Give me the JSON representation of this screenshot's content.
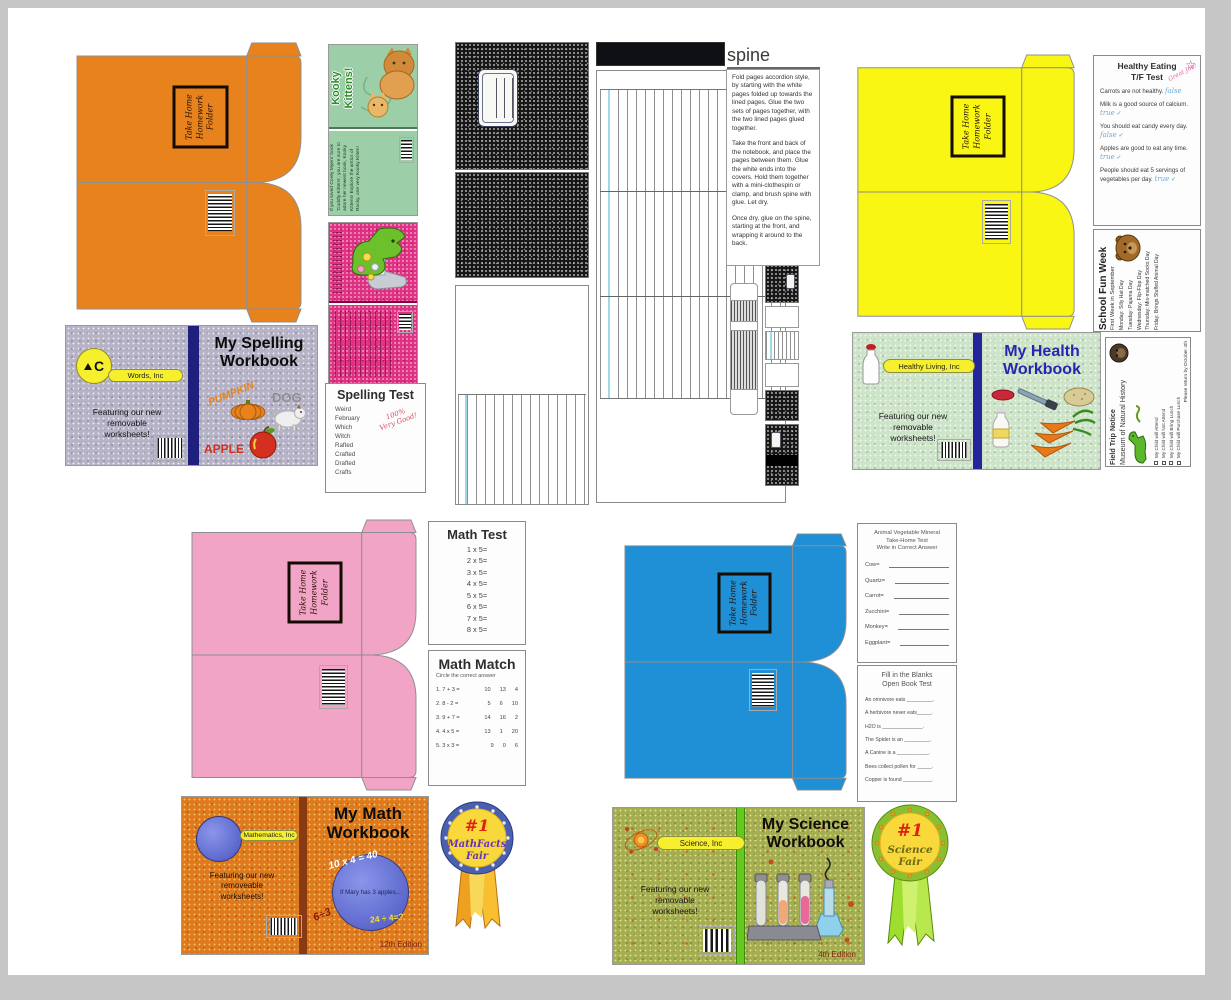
{
  "folder": {
    "label": "Take Home\nHomework\nFolder",
    "colors": {
      "orange": "#e8821c",
      "yellow": "#f8f612",
      "pink": "#f2a4c6",
      "blue": "#1f8fd6"
    }
  },
  "spelling_workbook": {
    "title": "My Spelling\nWorkbook",
    "company": "Words, Inc",
    "logo_letter": "C",
    "tagline": "Featuring our new\nremovable\nworksheets!",
    "words": {
      "pumpkin": "PUMPKIN",
      "dog": "DOG",
      "apple": "APPLE"
    },
    "cover_color": "#b7b3c7",
    "spine_color": "#1f1f7e"
  },
  "health_workbook": {
    "title": "My Health\nWorkbook",
    "company": "Healthy Living, Inc",
    "tagline": "Featuring our new\nremovable\nworksheets!",
    "cover_color": "#cde4c9",
    "spine_color": "#24249b",
    "title_color": "#2626b0"
  },
  "math_workbook": {
    "title": "My Math\nWorkbook",
    "company": "Mathematics, Inc",
    "tagline": "Featuring our new\nremoveable\nworksheets!",
    "edition": "12th Edition",
    "equations": {
      "eq1": "10 x 4 = 40",
      "eq2": "If Mary has 3 apples...",
      "eq3": "24 ÷ 4=?",
      "eq4": "6÷3"
    },
    "cover_color": "#df7a1c",
    "spine_color": "#8a3a12"
  },
  "science_workbook": {
    "title": "My Science\nWorkbook",
    "company": "Science, Inc",
    "tagline": "Featuring our new\nremovable\nworksheets!",
    "edition": "4th Edition",
    "cover_color": "#a5ad52",
    "spine_color": "#66c81e"
  },
  "spelling_test": {
    "title": "Spelling Test",
    "words": [
      "Weird",
      "February",
      "Which",
      "Witch",
      "Rafted",
      "Crafted",
      "Drafted",
      "Crafts"
    ],
    "grade": "100%\nVery Good!"
  },
  "math_test": {
    "title": "Math Test",
    "problems": [
      "1 x 5=",
      "2 x 5=",
      "3 x 5=",
      "4 x 5=",
      "5 x 5=",
      "6 x 5=",
      "7 x 5=",
      "8 x 5="
    ]
  },
  "math_match": {
    "title": "Math Match",
    "subtitle": "Circle the correct answer",
    "rows": [
      {
        "q": "1.  7 + 3 =",
        "opts": [
          "10",
          "13",
          "4"
        ]
      },
      {
        "q": "2.  8 - 2 =",
        "opts": [
          "5",
          "6",
          "10"
        ]
      },
      {
        "q": "3.  9 + 7 =",
        "opts": [
          "14",
          "16",
          "2"
        ]
      },
      {
        "q": "4.  4 x 5 =",
        "opts": [
          "13",
          "1",
          "20"
        ]
      },
      {
        "q": "5.  3 x 3 =",
        "opts": [
          "9",
          "0",
          "6"
        ]
      }
    ]
  },
  "healthy_test": {
    "title_line1": "Healthy Eating",
    "title_line2": "T/F Test",
    "note": "Great Job!",
    "questions": [
      {
        "text": "Carrots are not healthy.",
        "answer": "false",
        "check": ""
      },
      {
        "text": "Milk is a good source of calcium.",
        "answer": "true",
        "check": "✓"
      },
      {
        "text": "You should eat candy every day.",
        "answer": "false",
        "check": "✓"
      },
      {
        "text": "Apples are good to eat any time.",
        "answer": "true",
        "check": "✓"
      },
      {
        "text": "People should eat 5 servings of vegetables per day.",
        "answer": "true",
        "check": "✓"
      }
    ]
  },
  "fun_week": {
    "title": "School Fun Week",
    "subtitle": "First Week in September",
    "days": [
      "Monday:  Silly Hat Day",
      "Tuesday:  Pajama Day",
      "Wednesday:  Flip-Flop Day",
      "Thursday:  Mis-matched Socks Day",
      "Friday:  Brings Stuffed Animal Day"
    ]
  },
  "field_trip": {
    "title": "Field Trip Notice",
    "subtitle": "Museum of Natural History",
    "options": [
      "My Child will Attend",
      "My Child will Not Attend",
      "My Child will Bring Lunch",
      "My Child will Purchase Lunch"
    ],
    "footer": "Please return by October 4th"
  },
  "avm_test": {
    "title": "Animal Vegetable Mineral\nTake-Home Test\nWrite in Correct Answer",
    "items": [
      "Cow=",
      "Quartz=",
      "Carrot=",
      "Zucchini=",
      "Monkey=",
      "Eggplant="
    ]
  },
  "open_book_test": {
    "title": "Fill in the Blanks\nOpen Book Test",
    "items": [
      "An omnivore eats _________.",
      "A herbivore never eats_____.",
      "H2O is ______________.",
      "The Spider is an _________.",
      "A Canine is a ___________.",
      "Bees collect pollen for _____.",
      "Copper is found __________."
    ]
  },
  "spine_panel": {
    "title": "spine",
    "p1": "Fold pages accordion style, by starting with the white pages folded up towards the lined pages. Glue the two sets of pages together, with the two lined pages glued together.",
    "p2": "Take the front and back of the notebook, and place the pages between them. Glue the white ends into the covers.  Hold them together with a mini-clothespin or clamp, and brush spine with glue. Let dry.",
    "p3": "Once dry, glue on the spine, starting at the front, and wrapping it around to the back."
  },
  "kitten_book": {
    "title": "Kooky\nKittens!",
    "back_text": "If you loved Corey Myers' book 'Cuddly Kittens', you are sure to adore her newest book, Kooky Kittens!  Explore the antics of Rocky, one very Kooky Kitten!"
  },
  "ribbons": {
    "math": {
      "rank": "#1",
      "line1": "MathFacts",
      "line2": "Fair"
    },
    "science": {
      "rank": "#1",
      "line1": "Science",
      "line2": "Fair"
    }
  }
}
